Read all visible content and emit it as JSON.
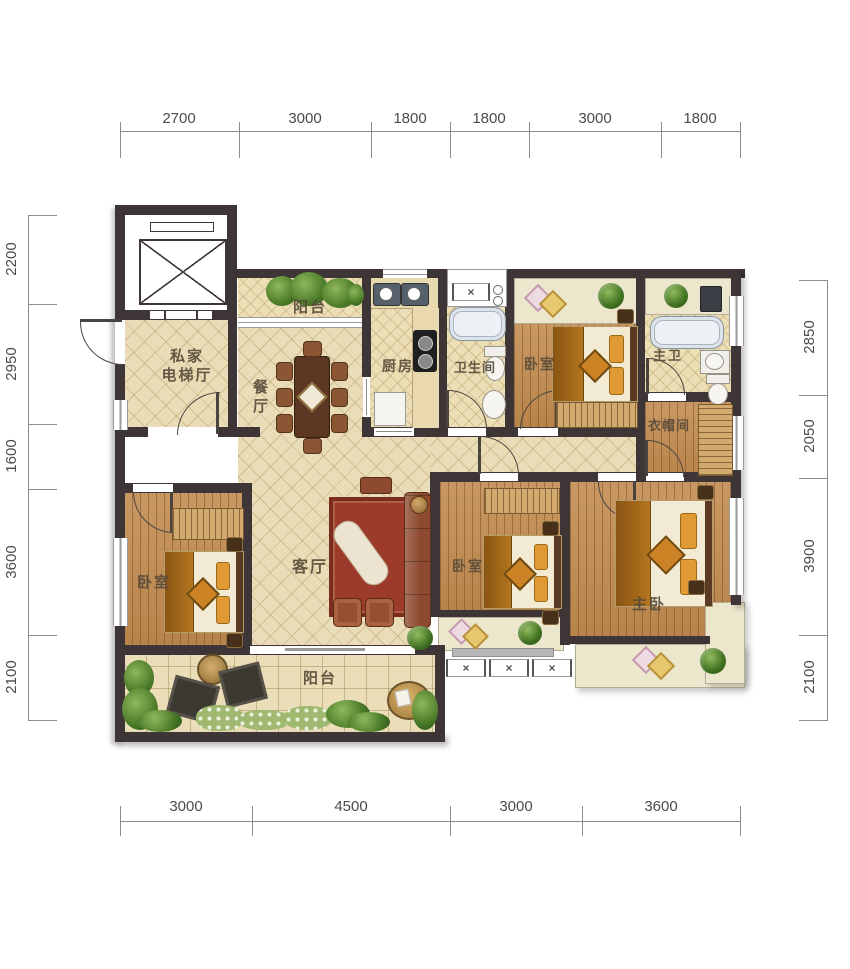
{
  "plan_title": "4-bedroom residential floor plan",
  "dims": {
    "top": [
      "2700",
      "3000",
      "1800",
      "1800",
      "3000",
      "1800"
    ],
    "bottom": [
      "3000",
      "4500",
      "3000",
      "3600"
    ],
    "left": [
      "2200",
      "2950",
      "1600",
      "3600",
      "2100"
    ],
    "right": [
      "2850",
      "2050",
      "3900",
      "2100"
    ]
  },
  "rooms": {
    "elevator_hall": [
      "私家",
      "电梯厅"
    ],
    "balcony_top": "阳台",
    "dining": "餐厅",
    "kitchen": "厨房",
    "bathroom": "卫生间",
    "bedroom_top": "卧室",
    "master_bath": "主卫",
    "cloakroom": "衣帽间",
    "bedroom_left": "卧室",
    "living": "客厅",
    "bedroom_mid": "卧室",
    "master_bedroom": "主卧",
    "balcony_bottom": "阳台"
  },
  "icons": {
    "cross": "×"
  },
  "colors": {
    "wall": "#3d3536",
    "tile_floor": "#e9dcb6",
    "wood_floor": "#c38c50",
    "rug": "#9c3b2b",
    "greenery": "#4a7a28",
    "dim_text": "#4b4b4b",
    "label_text": "#564a3a"
  }
}
